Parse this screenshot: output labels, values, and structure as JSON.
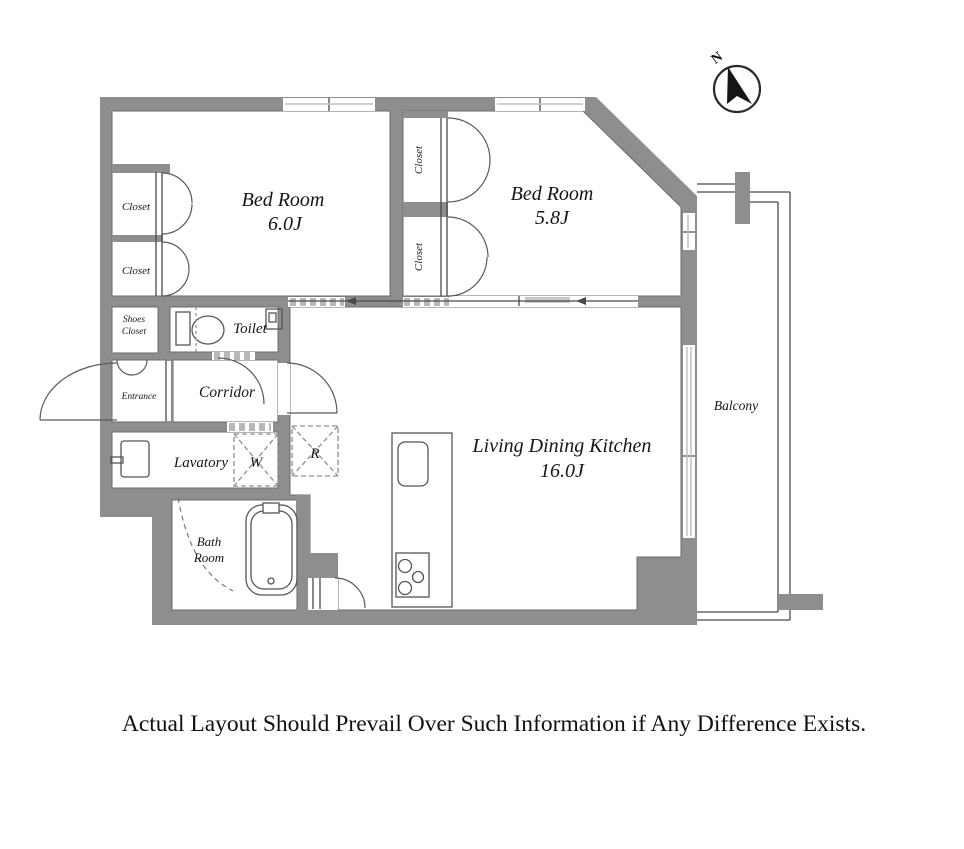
{
  "compass": {
    "north_label": "N"
  },
  "rooms": {
    "bedroom_a": {
      "name": "Bed Room",
      "size": "6.0J"
    },
    "bedroom_b": {
      "name": "Bed Room",
      "size": "5.8J"
    },
    "ldk": {
      "name": "Living Dining Kitchen",
      "size": "16.0J"
    },
    "balcony": {
      "name": "Balcony"
    },
    "toilet": {
      "name": "Toilet"
    },
    "corridor": {
      "name": "Corridor"
    },
    "entrance": {
      "name": "Entrance"
    },
    "lavatory": {
      "name": "Lavatory"
    },
    "bath_room": {
      "line1": "Bath",
      "line2": "Room"
    },
    "shoes_closet": {
      "line1": "Shoes",
      "line2": "Closet"
    },
    "closet_left_top": {
      "label": "Closet"
    },
    "closet_left_bottom": {
      "label": "Closet"
    },
    "closet_mid_top": {
      "label": "Closet"
    },
    "closet_mid_bottom": {
      "label": "Closet"
    }
  },
  "appliances": {
    "washing_machine": "W",
    "refrigerator": "R"
  },
  "disclaimer": "Actual Layout Should Prevail Over Such Information if Any Difference Exists.",
  "colors": {
    "wall": "#8e8e8e",
    "line": "#4a4a4a",
    "window_line": "#c2c2c2",
    "text": "#161616"
  }
}
